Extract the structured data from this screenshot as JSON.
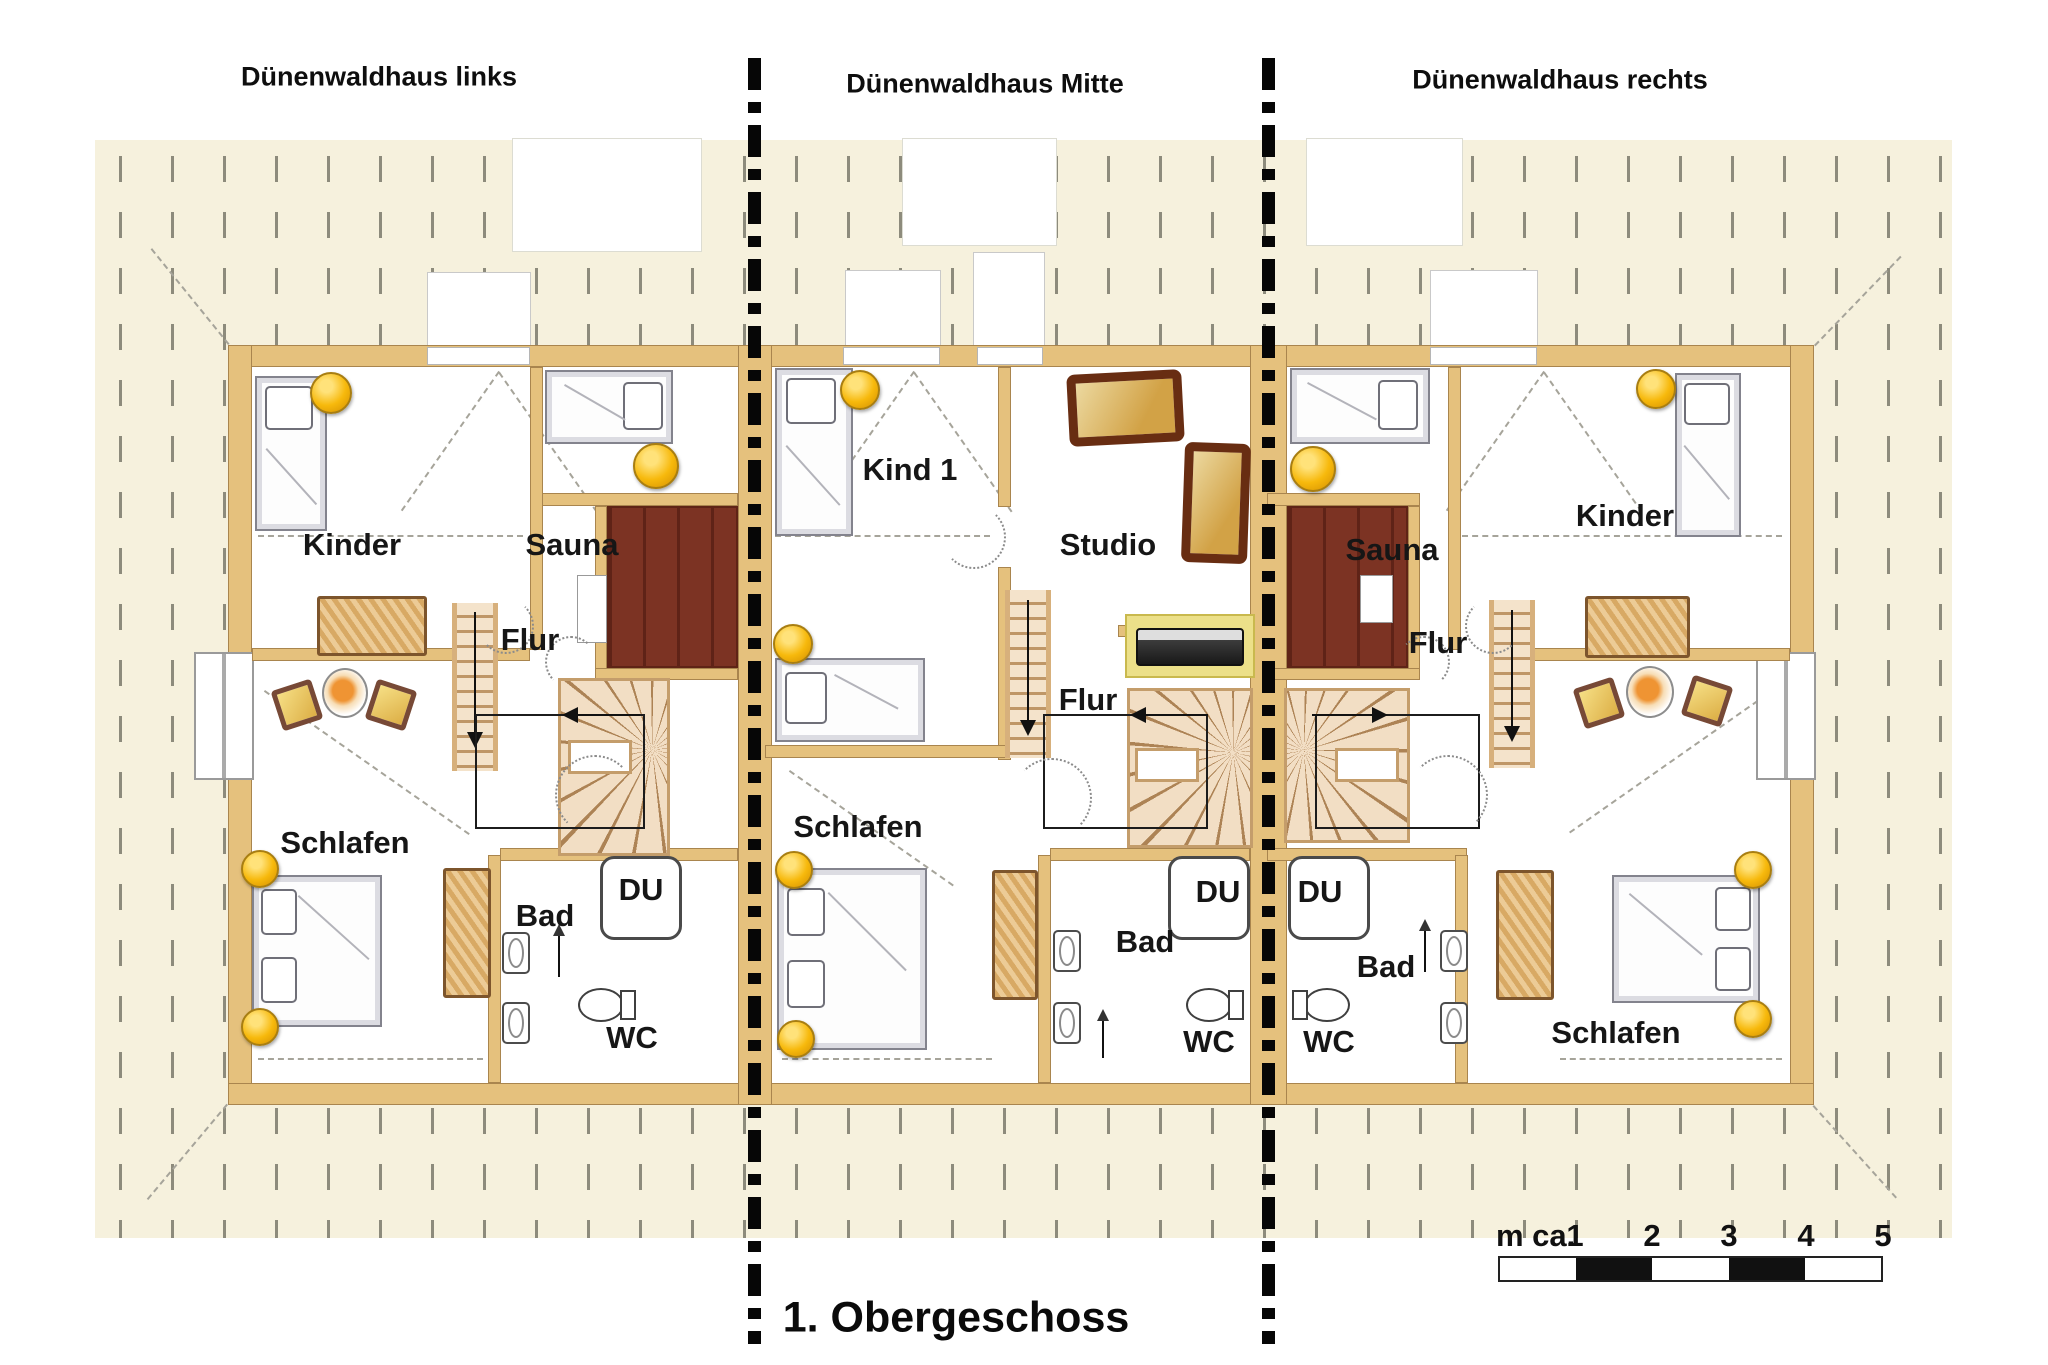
{
  "title": "1. Obergeschoss",
  "houses": {
    "links": {
      "name": "Dünenwaldhaus links",
      "rooms": {
        "kinder": "Kinder",
        "sauna": "Sauna",
        "flur": "Flur",
        "schlafen": "Schlafen",
        "bad": "Bad",
        "du": "DU",
        "wc": "WC"
      }
    },
    "mitte": {
      "name": "Dünenwaldhaus Mitte",
      "rooms": {
        "kind1": "Kind 1",
        "studio": "Studio",
        "flur": "Flur",
        "schlafen": "Schlafen",
        "bad": "Bad",
        "du": "DU",
        "wc": "WC"
      }
    },
    "rechts": {
      "name": "Dünenwaldhaus rechts",
      "rooms": {
        "sauna": "Sauna",
        "flur": "Flur",
        "kinder": "Kinder",
        "bad": "Bad",
        "du": "DU",
        "wc": "WC",
        "schlafen": "Schlafen"
      }
    }
  },
  "scale_bar": {
    "unit_label": "m ca.",
    "ticks": [
      "1",
      "2",
      "3",
      "4",
      "5"
    ]
  },
  "colors": {
    "roof": "#f6f1dd",
    "wall": "#e5c17d",
    "sauna_floor": "#7c3323",
    "lamp_yellow": "#f5b200",
    "separator": "#000000"
  }
}
